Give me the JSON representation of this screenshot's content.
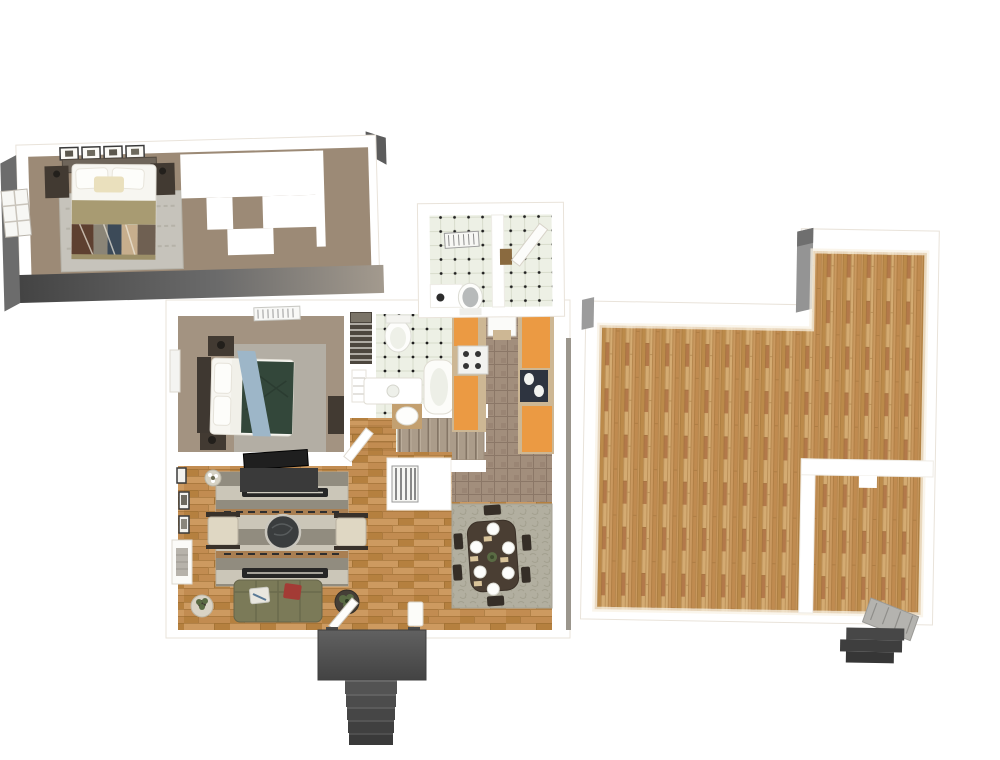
{
  "palette": {
    "bg": "#ffffff",
    "wall_white": "#ffffff",
    "wall_shadow": "#efe9e0",
    "wall_gray": "#949494",
    "wall_dark": "#5c5c5c",
    "exterior_dark": "#454545",
    "exterior_light": "#a69f94",
    "carpet_upper": "#9c8a76",
    "carpet_main": "#a39381",
    "rug_gray": "#c6c3bb",
    "bedroom_rug": "#b3aea4",
    "wood_a": "#c28c51",
    "wood_b": "#b5803f",
    "wood_c": "#cd9a60",
    "wood_line": "#96672e",
    "bwood_a": "#c9985f",
    "bwood_b": "#bb8a4a",
    "bwood_c": "#d4ab72",
    "bwood_d": "#c08b50",
    "bwood_line": "#9a6c35",
    "tile_bg": "#edf0e5",
    "tile_line": "#d8dccc",
    "tile_dot": "#1f1f1f",
    "ktile_bg": "#a28e7c",
    "ktile_line": "#8b7767",
    "cab_orange": "#eb9a43",
    "cab_tan": "#cdb794",
    "sink_dark": "#2e3440",
    "stair_bg": "#ab9c8a",
    "stair_line": "#857666",
    "lr_stripe_light": "#cbc6b8",
    "lr_stripe_dark": "#918c7f",
    "lr_bar": "#262626",
    "sofa": "#7b7a58",
    "armchair": "#dfd7c3",
    "coffee_table": "#3a3d3e",
    "dr_rug": "#b2afa0",
    "dr_table": "#4a3e33",
    "chair": "#352e27",
    "blanket_tan": "#a89b72",
    "blanket_green": "#33473a",
    "throw_blue": "#9db6c8",
    "bed_white": "#f7f6f1",
    "furn_dark": "#423a32",
    "porch": "#4f4f4f",
    "porch_dark": "#3a3a3a",
    "plant": "#5a6b44",
    "pillow_red": "#a33b35",
    "toilet_gray": "#b7baba",
    "sill_brown": "#8a6a3f"
  },
  "scene": {
    "view": "3d-top-down-floor-plan-render",
    "levels": [
      {
        "name": "upper-level",
        "rooms": [
          {
            "name": "bedroom",
            "objects": [
              "double-bed",
              "wall-picture-frames",
              "headboard",
              "nightstand-left",
              "nightstand-right",
              "area-rug",
              "closet-unit",
              "window",
              "exterior-walls"
            ]
          },
          {
            "name": "bathroom",
            "objects": [
              "shower-vent",
              "divider-wall",
              "toilet",
              "counter",
              "door"
            ]
          }
        ]
      },
      {
        "name": "main-level",
        "rooms": [
          {
            "name": "bedroom",
            "objects": [
              "double-bed",
              "nightstand-top",
              "nightstand-bottom",
              "dresser",
              "area-rug",
              "ceiling-vent",
              "window"
            ]
          },
          {
            "name": "closet",
            "objects": [
              "wire-shelves",
              "clothes"
            ]
          },
          {
            "name": "bathroom",
            "objects": [
              "toilet",
              "vanity",
              "bathtub",
              "wood-mat-fixture",
              "linen-shelves"
            ]
          },
          {
            "name": "hallway",
            "objects": [
              "carpeted-staircase",
              "wood-landing",
              "stair-railing",
              "furnace-grate-nook"
            ]
          },
          {
            "name": "kitchen",
            "objects": [
              "left-cabinet-run",
              "stove",
              "right-cabinet-run",
              "sink",
              "refrigerator",
              "tile-floor"
            ]
          },
          {
            "name": "living-room",
            "objects": [
              "striped-rug",
              "tv-console",
              "tv",
              "coffee-table",
              "armchair-left",
              "armchair-right",
              "sofa",
              "side-table-left",
              "side-table-right",
              "corner-plant",
              "wall-frames",
              "fireplace-shelf"
            ]
          },
          {
            "name": "dining-room",
            "objects": [
              "textured-rug",
              "dining-table",
              "six-chairs",
              "place-settings",
              "centerpiece"
            ]
          },
          {
            "name": "entry",
            "objects": [
              "front-door",
              "column",
              "porch-landing",
              "porch-steps"
            ]
          }
        ]
      },
      {
        "name": "basement-level",
        "rooms": [
          {
            "name": "open-area",
            "objects": [
              "hardwood-floor",
              "l-shaped-walls",
              "gray-wall-faces"
            ]
          },
          {
            "name": "utility-room",
            "objects": [
              "interior-walls",
              "wall-tab",
              "stair-ramp",
              "exterior-steps"
            ]
          }
        ]
      }
    ]
  }
}
